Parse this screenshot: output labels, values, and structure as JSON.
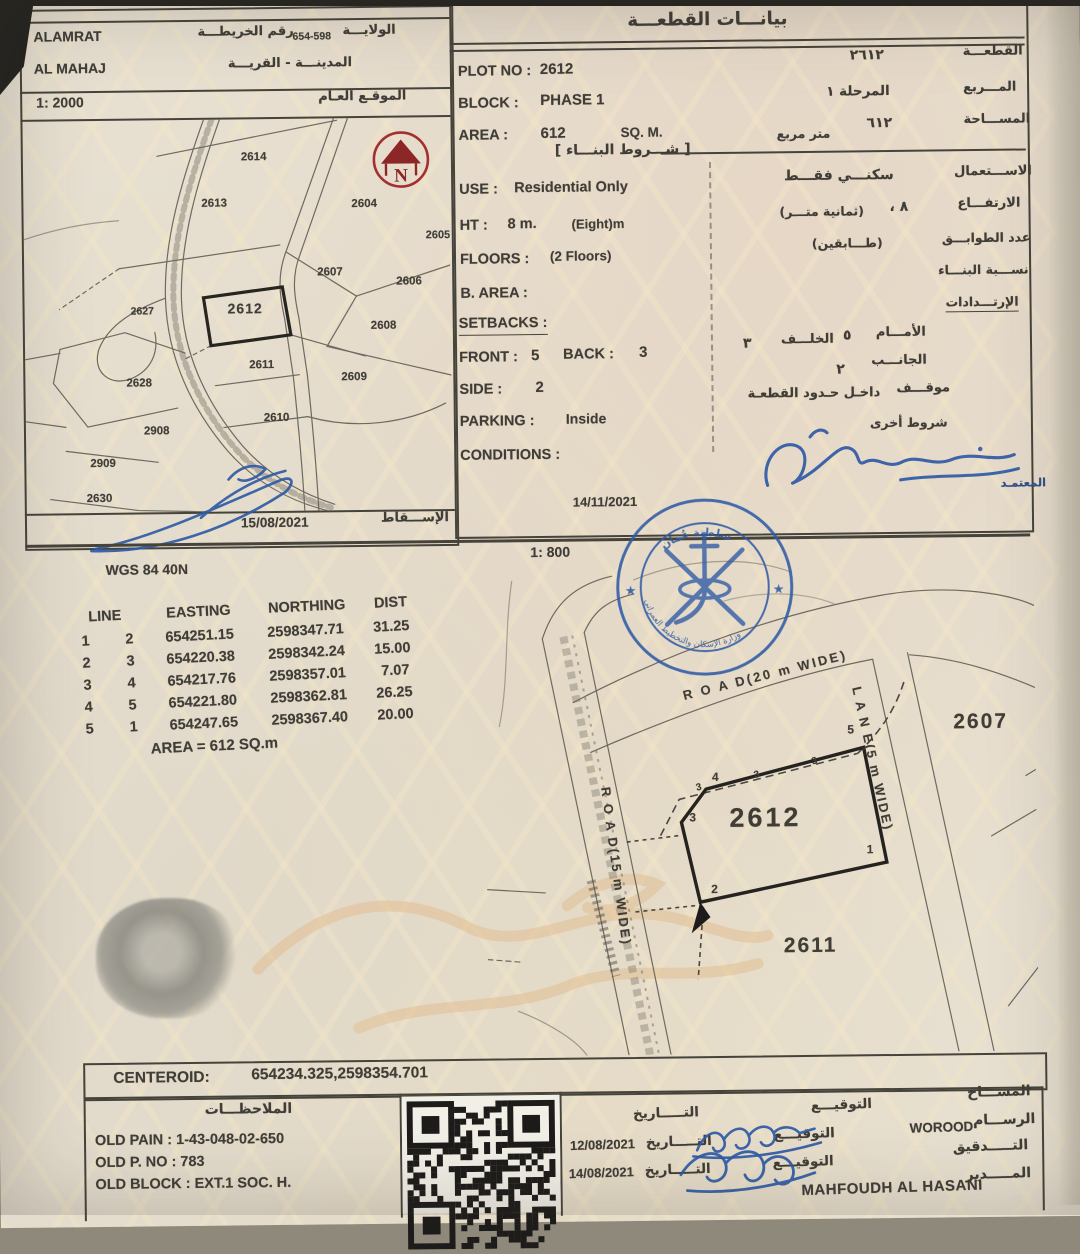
{
  "top_left": {
    "region1": "ALAMRAT",
    "region2": "AL MAHAJ",
    "map_no_label": "رقم الخريطـــة",
    "map_no": "654-598",
    "wilaya": "الولايـــة",
    "city_village": "المدينـــة - القريـــة",
    "scale": "1: 2000",
    "general_location": "الموقـع العـام",
    "survey_date": "15/08/2021",
    "projection": "الإســـقاط",
    "north_letter": "N",
    "plots": [
      "2614",
      "2613",
      "2604",
      "2605",
      "2607",
      "2606",
      "2627",
      "2612",
      "2608",
      "2611",
      "2609",
      "2628",
      "2610",
      "2908",
      "2909",
      "2630"
    ]
  },
  "plot_info": {
    "title": "بيانـــات القطعـــة",
    "plot_no_label": "PLOT NO :",
    "plot_no": "2612",
    "plot_no_ar": "٢٦١٢",
    "plot_no_label_ar": "القطعـــة",
    "block_label": "BLOCK :",
    "block": "PHASE 1",
    "block_ar": "المرحلة ١",
    "block_label_ar": "المـــربع",
    "area_label": "AREA :",
    "area": "612",
    "area_unit": "SQ. M.",
    "area_ar": "٦١٢",
    "area_unit_ar": "متر مربع",
    "area_label_ar": "المســـاحة",
    "conditions_title": "[ شـــروط البنـــاء ]",
    "use_label": "USE :",
    "use": "Residential Only",
    "use_ar": "سكنـــي فقـــط",
    "use_label_ar": "الاســـتعمال",
    "ht_label": "HT :",
    "ht": "8 m.",
    "ht_note": "(Eight)m",
    "ht_ar": "٨ ،",
    "ht_note_ar": "(ثمانية متـــر)",
    "ht_label_ar": "الارتفـــاع",
    "floors_label": "FLOORS :",
    "floors": "(2 Floors)",
    "floors_ar": "(طـــابقين)",
    "floors_label_ar": "عدد الطوابـــق",
    "barea_label": "B. AREA :",
    "barea_label_ar": "نســـبة البنـــاء",
    "setbacks_label_ar": "الإرتـــدادات",
    "setbacks_heading": "SETBACKS :",
    "front_label": "FRONT :",
    "front": "5",
    "back_label": "BACK :",
    "back": "3",
    "front_label_ar": "الأمـــام",
    "front_ar": "٥",
    "back_label_ar": "الخلـــف",
    "back_ar": "٣",
    "side_label": "SIDE :",
    "side": "2",
    "side_label_ar": "الجانـــب",
    "side_ar": "٢",
    "parking_label": "PARKING :",
    "parking": "Inside",
    "parking_label_ar": "موقـــف",
    "parking_ar": "داخـل حـدود القطعـة",
    "conditions_label": "CONDITIONS :",
    "other_conditions_ar": "شروط أخرى",
    "approved_ar": "المعتمـد",
    "approval_date": "14/11/2021"
  },
  "survey": {
    "scale": "1: 800",
    "datum": "WGS 84  40N",
    "headers": {
      "line": "LINE",
      "easting": "EASTING",
      "northing": "NORTHING",
      "dist": "DIST"
    },
    "rows": [
      {
        "from": "1",
        "to": "2",
        "easting": "654251.15",
        "northing": "2598347.71",
        "dist": "31.25"
      },
      {
        "from": "2",
        "to": "3",
        "easting": "654220.38",
        "northing": "2598342.24",
        "dist": "15.00"
      },
      {
        "from": "3",
        "to": "4",
        "easting": "654217.76",
        "northing": "2598357.01",
        "dist": "7.07"
      },
      {
        "from": "4",
        "to": "5",
        "easting": "654221.80",
        "northing": "2598362.81",
        "dist": "26.25"
      },
      {
        "from": "5",
        "to": "1",
        "easting": "654247.65",
        "northing": "2598367.40",
        "dist": "20.00"
      }
    ],
    "area_note": "AREA = 612  SQ.m"
  },
  "main_map": {
    "plot": "2612",
    "below": "2611",
    "right": "2607",
    "road20": "R O A D(20 m WIDE)",
    "road15": "R O A D(15 m WIDE)",
    "lane": "L A N E(5 m WIDE)",
    "v1": "1",
    "v2": "2",
    "v3": "3",
    "v4": "4",
    "v5": "5",
    "setback_mark": "3"
  },
  "stamp": {
    "top_text": "سلطنة عُمان",
    "bottom_text": "وزارة الإسكان والتخطيط العمراني",
    "star": "★"
  },
  "centroid": {
    "label": "CENTEROID:",
    "value": "654234.325,2598354.701"
  },
  "notes": {
    "title": "الملاحظـــات",
    "line1": "OLD PAIN : 1-43-048-02-650",
    "line2": "OLD P. NO : 783",
    "line3": "OLD BLOCK : EXT.1  SOC. H."
  },
  "sign_table": {
    "sign_label": "التوقيـــع",
    "date_label": "التـــــاريخ",
    "surveyor_ar": "المســـاح",
    "draftsman_ar": "الرســـام",
    "draftsman_name": "WOROOD",
    "draftsman_date": "12/08/2021",
    "check_ar": "التـــــدقيق",
    "check_date": "14/08/2021",
    "manager_ar": "المـــــدير",
    "manager_name": "MAHFOUDH AL HASANI"
  }
}
